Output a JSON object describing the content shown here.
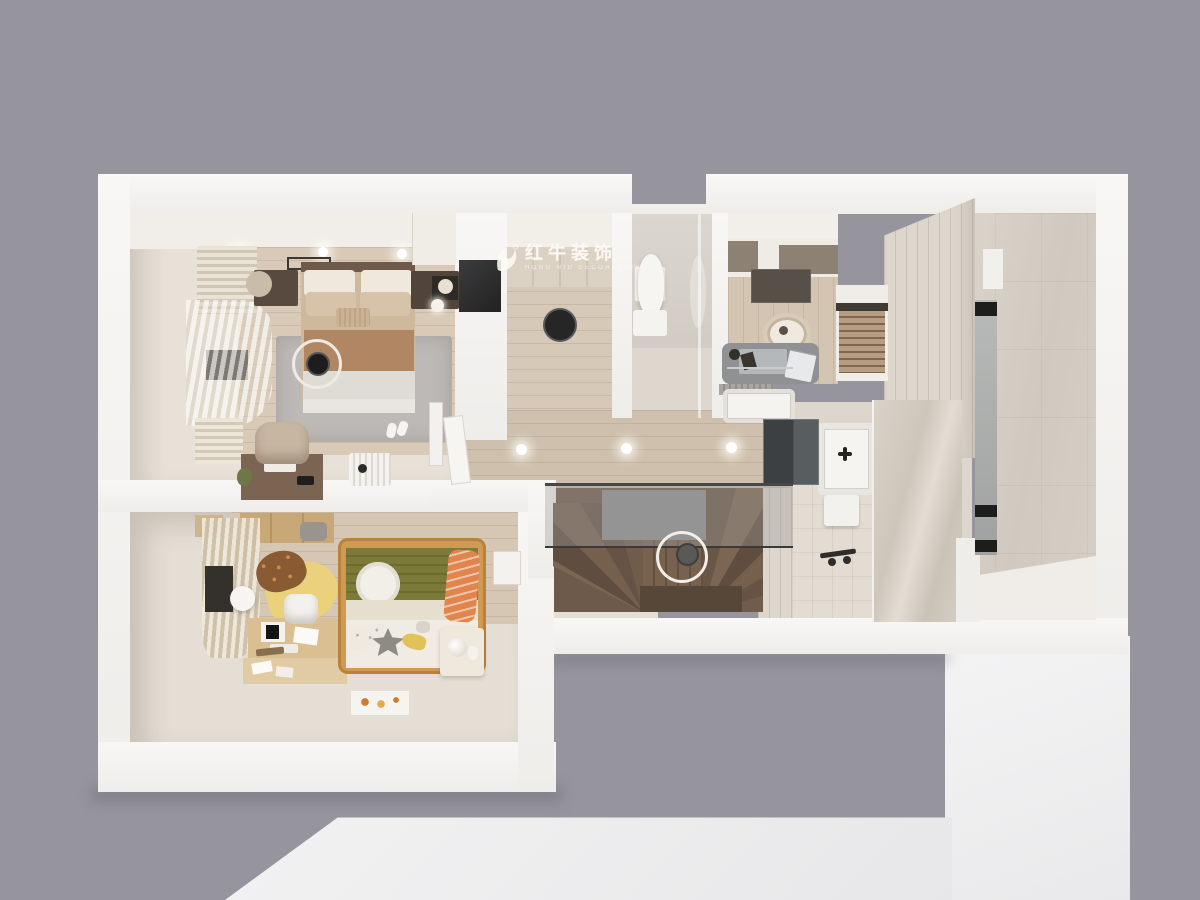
{
  "watermark": {
    "brand": "红牛装饰",
    "subtitle": "HONG NIU DECORATION",
    "icon": "bull-logo"
  },
  "scene": {
    "description": "top-down 3D dollhouse render of an apartment floor plan",
    "view": "top-down axonometric",
    "rooms": [
      {
        "id": "master-bedroom",
        "contents": [
          "double-bed",
          "rug",
          "nightstands",
          "sphere-lamp",
          "desk",
          "chair",
          "radiator",
          "curtains",
          "tv",
          "pendant-ring-lamp"
        ]
      },
      {
        "id": "kids-bedroom",
        "contents": [
          "kids-bed",
          "acorn-rug",
          "study-desk",
          "white-chair",
          "fox-pillow",
          "nightstand",
          "curtains",
          "paper-lantern"
        ]
      },
      {
        "id": "hallway",
        "contents": [
          "wood-floor",
          "recessed-lights",
          "open-door",
          "shoe-cabinet"
        ]
      },
      {
        "id": "staircase",
        "contents": [
          "winder-stairs",
          "glass-railing",
          "ring-pendant-light"
        ]
      },
      {
        "id": "toilet-room",
        "contents": [
          "toilet",
          "water-heater",
          "glass-partition"
        ]
      },
      {
        "id": "study-room",
        "contents": [
          "wardrobe",
          "gray-desk",
          "laptop",
          "round-chair",
          "wood-blinds-window",
          "doormat",
          "bathtub"
        ]
      },
      {
        "id": "bathroom",
        "contents": [
          "mirror-cabinet",
          "sink",
          "shower-fixture",
          "glass-shower-wall",
          "curb"
        ]
      },
      {
        "id": "shower-room",
        "contents": [
          "tiled-walls",
          "niche",
          "shelf"
        ]
      }
    ]
  },
  "palette": {
    "bg": "#96959d",
    "wall": "#f6f5f2",
    "plane": "#f0f0f1",
    "cream-floor": "#e4ded5",
    "wood-warm": "#d9cab8",
    "wood-hall": "#cec0ac",
    "wood-kids": "#d6c7b4",
    "stair-brown": "#6e5a4b",
    "stair-dark": "#564739",
    "rug-gray": "#bdb9b6",
    "blanket-terracotta": "#b08663",
    "blanket-olive": "#7c7a39",
    "fox-orange": "#e1854f",
    "acorn-yellow": "#ebd17b",
    "acorn-brown": "#8a5a33",
    "taupe-cabinet": "#8d8174",
    "desk-gray": "#8f9193",
    "tile-beige": "#dcd6cd",
    "tile-grout": "#c8c1b6",
    "glass-gray": "#8f8e91",
    "dark-fixture": "#3f4346",
    "watermark": "rgba(252,250,245,0.88)"
  }
}
